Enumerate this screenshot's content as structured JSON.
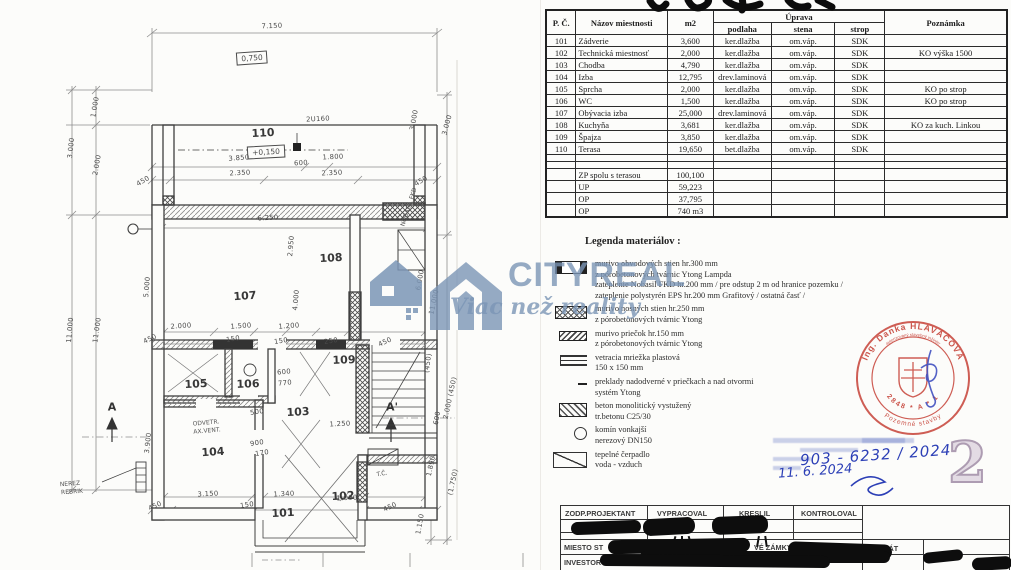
{
  "watermark": {
    "brand": "CITYREAL",
    "tagline": "Viac než reality"
  },
  "room_table": {
    "headers": {
      "pc": "P. Č.",
      "name": "Názov miestnosti",
      "area": "m2",
      "uprava": "Úprava",
      "podlaha": "podlaha",
      "stena": "stena",
      "strop": "strop",
      "note": "Poznámka"
    },
    "rows": [
      {
        "pc": "101",
        "name": "Zádverie",
        "m2": "3,600",
        "podlaha": "ker.dlažba",
        "stena": "om.váp.",
        "strop": "SDK",
        "note": ""
      },
      {
        "pc": "102",
        "name": "Technická miestnosť",
        "m2": "2,000",
        "podlaha": "ker.dlažba",
        "stena": "om.váp.",
        "strop": "SDK",
        "note": "KO výška 1500"
      },
      {
        "pc": "103",
        "name": "Chodba",
        "m2": "4,790",
        "podlaha": "ker.dlažba",
        "stena": "om.váp.",
        "strop": "SDK",
        "note": ""
      },
      {
        "pc": "104",
        "name": "Izba",
        "m2": "12,795",
        "podlaha": "drev.laminová",
        "stena": "om.váp.",
        "strop": "SDK",
        "note": ""
      },
      {
        "pc": "105",
        "name": "Sprcha",
        "m2": "2,000",
        "podlaha": "ker.dlažba",
        "stena": "om.váp.",
        "strop": "SDK",
        "note": "KO po strop"
      },
      {
        "pc": "106",
        "name": "WC",
        "m2": "1,500",
        "podlaha": "ker.dlažba",
        "stena": "om.váp.",
        "strop": "SDK",
        "note": "KO po strop"
      },
      {
        "pc": "107",
        "name": "Obývacia izba",
        "m2": "25,000",
        "podlaha": "drev.laminová",
        "stena": "om.váp.",
        "strop": "SDK",
        "note": ""
      },
      {
        "pc": "108",
        "name": "Kuchyňa",
        "m2": "3,681",
        "podlaha": "ker.dlažba",
        "stena": "om.váp.",
        "strop": "SDK",
        "note": "KO za kuch. Linkou"
      },
      {
        "pc": "109",
        "name": "Špajza",
        "m2": "3,850",
        "podlaha": "ker.dlažba",
        "stena": "om.váp.",
        "strop": "SDK",
        "note": ""
      },
      {
        "pc": "110",
        "name": "Terasa",
        "m2": "19,650",
        "podlaha": "bet.dlažba",
        "stena": "om.váp.",
        "strop": "SDK",
        "note": ""
      }
    ],
    "summary": [
      {
        "name": "ZP spolu s terasou",
        "m2": "100,100"
      },
      {
        "name": "UP",
        "m2": "59,223"
      },
      {
        "name": "OP",
        "m2": "37,795"
      },
      {
        "name": "OP",
        "m2": "740 m3"
      }
    ]
  },
  "legend": {
    "title": "Legenda materiálov :",
    "items": [
      {
        "symbol": "wall-300",
        "lines": [
          "murivo obvodových stien hr.300 mm",
          "z pórobetonových tvárnic  Ytong Lampda",
          "zateplenie Nobasil FKD  hr.200 mm  / pre odstup 2 m  od hranice pozemku /",
          "zateplenie polystyrén EPS hr.200 mm Grafitový / ostatná časť /"
        ]
      },
      {
        "symbol": "wall-250",
        "lines": [
          "murivo nosných  stien hr.250 mm",
          "z pórobetonových tvárnic Ytong"
        ]
      },
      {
        "symbol": "wall-150",
        "lines": [
          "murivo priečok hr.150 mm",
          "z pórobetonových tvárnic  Ytong"
        ]
      },
      {
        "symbol": "vent",
        "lines": [
          "vetracia mriežka plastová",
          "150 x 150 mm"
        ]
      },
      {
        "symbol": "lintel",
        "lines": [
          "preklady  nadodverné  v priečkach a nad otvormi",
          "systém  Ytong"
        ]
      },
      {
        "symbol": "concrete",
        "lines": [
          "beton monolitický vystužený",
          "tr.betonu C25/30"
        ]
      },
      {
        "symbol": "chimney",
        "lines": [
          "komín vonkajší",
          "nerezový DN150"
        ]
      },
      {
        "symbol": "heatpump",
        "lines": [
          "tepelné čerpadlo",
          "voda - vzduch"
        ]
      }
    ]
  },
  "stamp": {
    "name": "Ing. Danka HLAVÁČOVÁ",
    "subtitle": "autorizovaný stavebný inžinier",
    "number": "2848 * A * 1",
    "category": "Pozemné stavby",
    "color": "#c64238"
  },
  "handwriting": {
    "ref_number": "903 - 6232 / 2024",
    "date": "11. 6. 2024"
  },
  "page_mark": "2",
  "title_block": {
    "headers": [
      "ZODP.PROJEKTANT",
      "VYPRACOVAL",
      "KRESLIL",
      "KONTROLOVAL"
    ],
    "miesto_label": "MIESTO ST",
    "miesto_visible": "VÉ ZÁMKY",
    "format_label": "FORMÁT",
    "investor_label": "INVESTOR"
  },
  "plan": {
    "labels": [
      {
        "t": "7.150",
        "x": 272,
        "y": 26,
        "r": -2,
        "c": "dim"
      },
      {
        "t": "0,750",
        "x": 252,
        "y": 58,
        "r": -4,
        "c": "dimb"
      },
      {
        "t": "2U160",
        "x": 318,
        "y": 119,
        "r": -3,
        "c": "dim"
      },
      {
        "t": "110",
        "x": 263,
        "y": 133,
        "r": -3,
        "c": "room"
      },
      {
        "t": "+0,150",
        "x": 266,
        "y": 152,
        "r": -3,
        "c": "dimb"
      },
      {
        "t": "3.850",
        "x": 239,
        "y": 158,
        "r": -4,
        "c": "dim"
      },
      {
        "t": "600",
        "x": 301,
        "y": 163,
        "r": -3,
        "c": "dim"
      },
      {
        "t": "1.800",
        "x": 333,
        "y": 157,
        "r": -3,
        "c": "dim"
      },
      {
        "t": "450",
        "x": 143,
        "y": 181,
        "r": -30,
        "c": "dim"
      },
      {
        "t": "2.350",
        "x": 240,
        "y": 173,
        "r": -3,
        "c": "dim"
      },
      {
        "t": "2.350",
        "x": 332,
        "y": 173,
        "r": -3,
        "c": "dim"
      },
      {
        "t": "450",
        "x": 421,
        "y": 181,
        "r": -30,
        "c": "dim"
      },
      {
        "t": "6.250",
        "x": 268,
        "y": 218,
        "r": -3,
        "c": "dim"
      },
      {
        "t": "3.000",
        "x": 71,
        "y": 148,
        "r": -84,
        "c": "dim"
      },
      {
        "t": "1.000",
        "x": 95,
        "y": 107,
        "r": -80,
        "c": "dim"
      },
      {
        "t": "2.000",
        "x": 97,
        "y": 165,
        "r": -80,
        "c": "dim"
      },
      {
        "t": "11.000",
        "x": 70,
        "y": 330,
        "r": -85,
        "c": "dim"
      },
      {
        "t": "11.000",
        "x": 97,
        "y": 330,
        "r": -82,
        "c": "dim"
      },
      {
        "t": "3.000",
        "x": 414,
        "y": 120,
        "r": -80,
        "c": "dim"
      },
      {
        "t": "3.000",
        "x": 447,
        "y": 125,
        "r": -75,
        "c": "dim"
      },
      {
        "t": "NOBASIL FKD",
        "x": 409,
        "y": 207,
        "r": -72,
        "c": "note"
      },
      {
        "t": "5.000",
        "x": 147,
        "y": 287,
        "r": -85,
        "c": "dim"
      },
      {
        "t": "2.950",
        "x": 291,
        "y": 246,
        "r": -85,
        "c": "dim"
      },
      {
        "t": "4.000",
        "x": 296,
        "y": 300,
        "r": -85,
        "c": "dim"
      },
      {
        "t": "107",
        "x": 245,
        "y": 296,
        "r": -4,
        "c": "room"
      },
      {
        "t": "108",
        "x": 331,
        "y": 258,
        "r": -3,
        "c": "room"
      },
      {
        "t": "2.000",
        "x": 181,
        "y": 326,
        "r": -4,
        "c": "dim"
      },
      {
        "t": "1.500",
        "x": 241,
        "y": 326,
        "r": -4,
        "c": "dim"
      },
      {
        "t": "1.200",
        "x": 289,
        "y": 326,
        "r": -4,
        "c": "dim"
      },
      {
        "t": "450",
        "x": 150,
        "y": 339,
        "r": -25,
        "c": "dim"
      },
      {
        "t": "150",
        "x": 233,
        "y": 339,
        "r": -8,
        "c": "dim"
      },
      {
        "t": "150",
        "x": 281,
        "y": 341,
        "r": -8,
        "c": "dim"
      },
      {
        "t": "250",
        "x": 331,
        "y": 341,
        "r": -8,
        "c": "dim"
      },
      {
        "t": "450",
        "x": 385,
        "y": 342,
        "r": -25,
        "c": "dim"
      },
      {
        "t": "105",
        "x": 196,
        "y": 384,
        "r": -3,
        "c": "room"
      },
      {
        "t": "106",
        "x": 248,
        "y": 384,
        "r": -2,
        "c": "room"
      },
      {
        "t": "103",
        "x": 298,
        "y": 412,
        "r": -3,
        "c": "room"
      },
      {
        "t": "109",
        "x": 344,
        "y": 360,
        "r": -2,
        "c": "room"
      },
      {
        "t": "600",
        "x": 284,
        "y": 372,
        "r": -5,
        "c": "dim"
      },
      {
        "t": "770",
        "x": 285,
        "y": 383,
        "r": -5,
        "c": "dim"
      },
      {
        "t": "500",
        "x": 257,
        "y": 412,
        "r": -8,
        "c": "dim"
      },
      {
        "t": "1.250",
        "x": 340,
        "y": 424,
        "r": -3,
        "c": "dim"
      },
      {
        "t": "104",
        "x": 213,
        "y": 452,
        "r": -4,
        "c": "room"
      },
      {
        "t": "ODVETR.",
        "x": 206,
        "y": 423,
        "r": -5,
        "c": "note"
      },
      {
        "t": "AX.VENT.",
        "x": 207,
        "y": 431,
        "r": -5,
        "c": "note"
      },
      {
        "t": "900",
        "x": 257,
        "y": 443,
        "r": -8,
        "c": "dim"
      },
      {
        "t": "170",
        "x": 262,
        "y": 453,
        "r": -8,
        "c": "dim"
      },
      {
        "t": "3.900",
        "x": 148,
        "y": 443,
        "r": -84,
        "c": "dim"
      },
      {
        "t": "6.000",
        "x": 420,
        "y": 280,
        "r": -80,
        "c": "dim"
      },
      {
        "t": "11.000",
        "x": 434,
        "y": 302,
        "r": -78,
        "c": "dim"
      },
      {
        "t": "(450)",
        "x": 428,
        "y": 363,
        "r": -82,
        "c": "dim"
      },
      {
        "t": "600",
        "x": 437,
        "y": 418,
        "r": -80,
        "c": "dim"
      },
      {
        "t": "2.000 (450)",
        "x": 450,
        "y": 398,
        "r": -78,
        "c": "dim"
      },
      {
        "t": "1.890",
        "x": 431,
        "y": 466,
        "r": -78,
        "c": "dim"
      },
      {
        "t": "(1.750)",
        "x": 453,
        "y": 482,
        "r": -78,
        "c": "dim"
      },
      {
        "t": "101",
        "x": 283,
        "y": 513,
        "r": -3,
        "c": "room"
      },
      {
        "t": "102",
        "x": 343,
        "y": 496,
        "r": -3,
        "c": "room"
      },
      {
        "t": "3.150",
        "x": 208,
        "y": 494,
        "r": -3,
        "c": "dim"
      },
      {
        "t": "1.340",
        "x": 284,
        "y": 494,
        "r": -3,
        "c": "dim"
      },
      {
        "t": "1.000",
        "x": 347,
        "y": 498,
        "r": -3,
        "c": "dim"
      },
      {
        "t": "450",
        "x": 155,
        "y": 506,
        "r": -25,
        "c": "dim"
      },
      {
        "t": "150",
        "x": 247,
        "y": 505,
        "r": -8,
        "c": "dim"
      },
      {
        "t": "450",
        "x": 390,
        "y": 507,
        "r": -25,
        "c": "dim"
      },
      {
        "t": "1.150",
        "x": 420,
        "y": 524,
        "r": -80,
        "c": "dim"
      },
      {
        "t": "T.Č.",
        "x": 382,
        "y": 474,
        "r": -10,
        "c": "note"
      },
      {
        "t": "A",
        "x": 112,
        "y": 407,
        "r": 0,
        "c": "sect"
      },
      {
        "t": "A'",
        "x": 392,
        "y": 407,
        "r": 0,
        "c": "sect"
      },
      {
        "t": "NEREZ",
        "x": 70,
        "y": 484,
        "r": -4,
        "c": "note"
      },
      {
        "t": "REBRIK",
        "x": 72,
        "y": 492,
        "r": -4,
        "c": "note"
      }
    ]
  }
}
